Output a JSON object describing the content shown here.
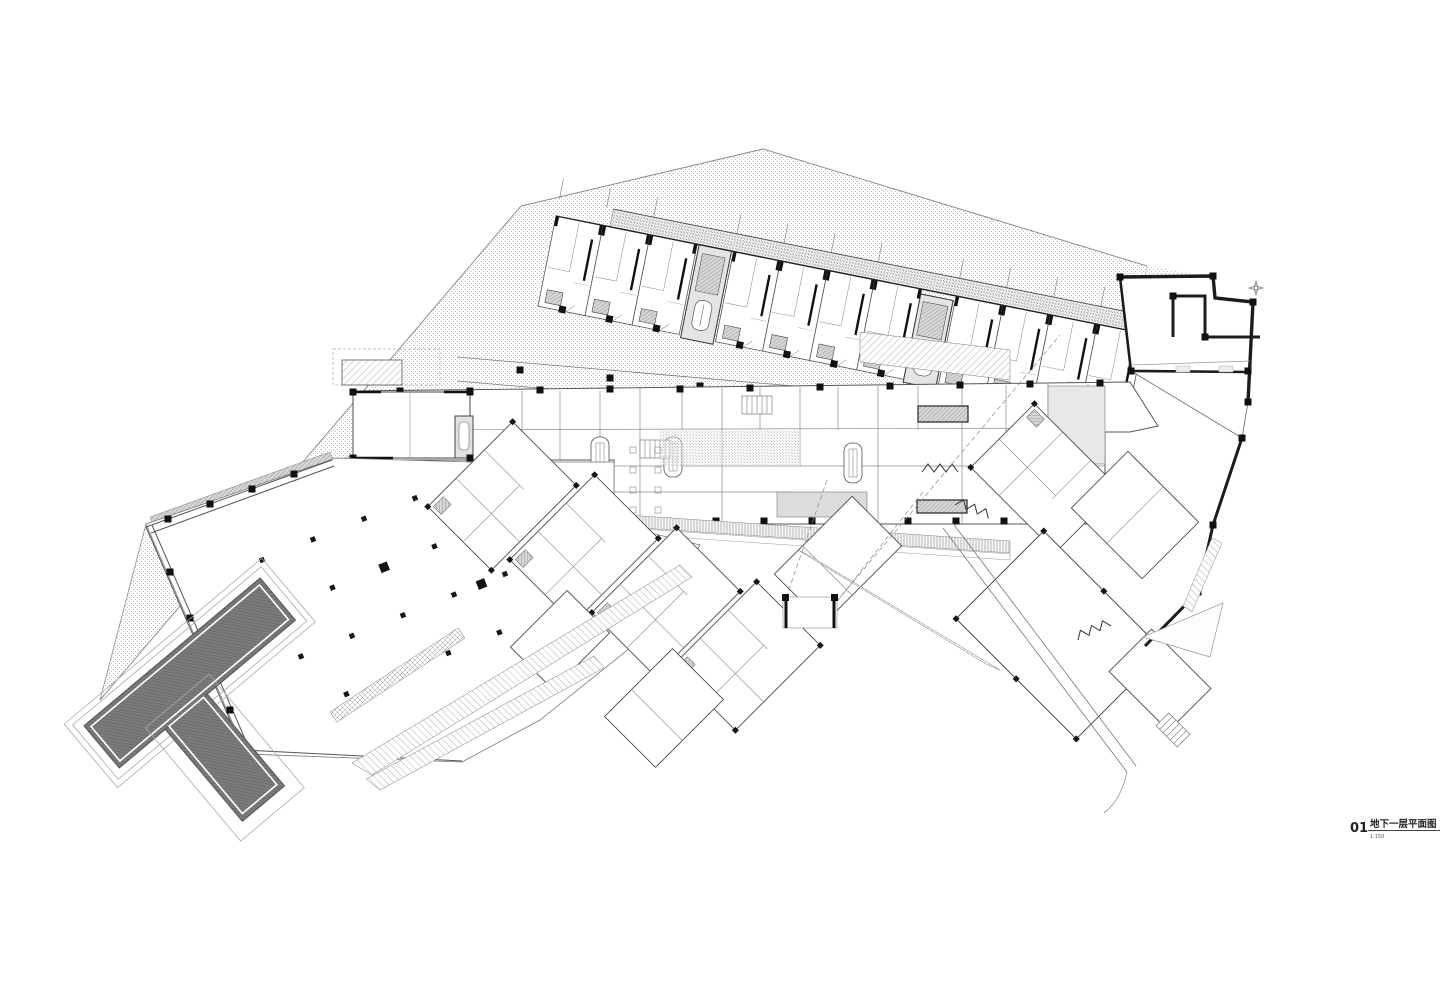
{
  "drawing": {
    "number": "01",
    "title": "地下一层平面图",
    "scale": "1:150"
  },
  "colors": {
    "paper": "#ffffff",
    "ink": "#3a3a3a",
    "heavy_wall": "#1c1c1c",
    "ramp_fill": "#757575",
    "hatch": "#9a9a9a",
    "light_fill": "#e2e2e2"
  },
  "icons": {
    "north_marker": "compass-star-icon"
  }
}
